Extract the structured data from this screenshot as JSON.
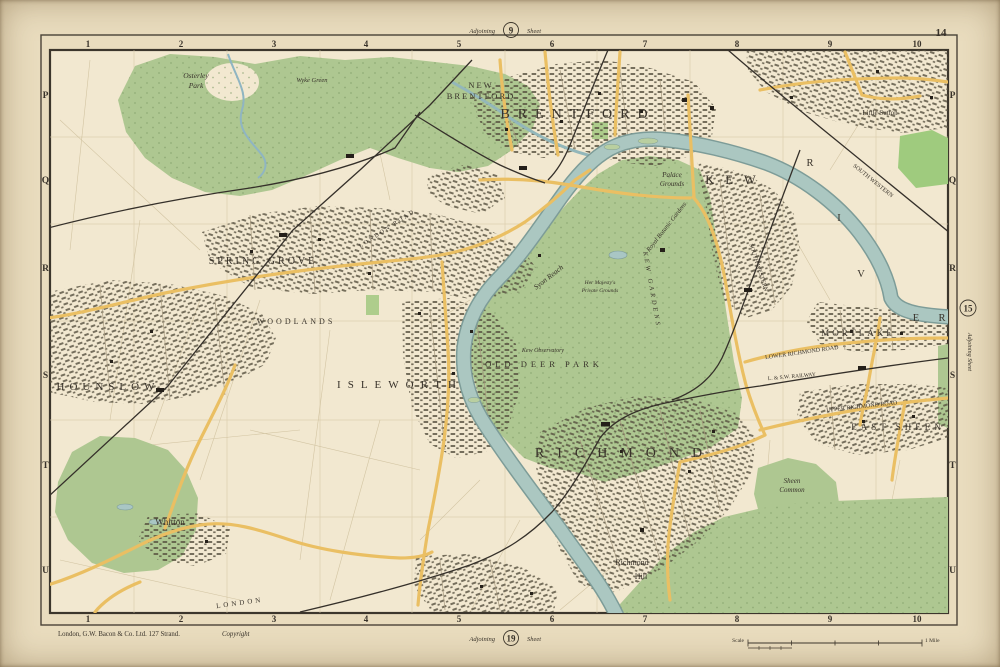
{
  "sheet": {
    "corner_number": "14",
    "adjoining_top": {
      "prefix": "Adjoining",
      "number": "9",
      "suffix": "Sheet"
    },
    "adjoining_bottom": {
      "prefix": "Adjoining",
      "number": "19",
      "suffix": "Sheet"
    },
    "adjoining_right": {
      "label": "Adjoining Sheet",
      "number": "15"
    }
  },
  "margin": {
    "columns": [
      "1",
      "2",
      "3",
      "4",
      "5",
      "6",
      "7",
      "8",
      "9",
      "10"
    ],
    "rows": [
      "P",
      "Q",
      "R",
      "S",
      "T",
      "U"
    ]
  },
  "imprint": {
    "publisher": "London, G.W. Bacon & Co. Ltd. 127 Strand.",
    "copyright": "Copyright"
  },
  "scale_bar": {
    "left_label": "Scale",
    "right_label": "1 Mile"
  },
  "colors": {
    "paper": "#e9dcbe",
    "map_background": "#f2e8d0",
    "park_green": "#aec791",
    "bright_green": "#9fcb7e",
    "river_blue": "#abc7c1",
    "river_edge": "#7d9c98",
    "road_yellow": "#eabf63",
    "railway_black": "#35302a",
    "frame_ink": "#3c362c"
  },
  "map": {
    "labels": [
      {
        "text": "NEW"
      },
      {
        "text": "BRENTFORD"
      },
      {
        "text": "BRENTFORD"
      },
      {
        "text": "KEW"
      },
      {
        "text": "R"
      },
      {
        "text": "I"
      },
      {
        "text": "V"
      },
      {
        "text": "E"
      },
      {
        "text": "R"
      },
      {
        "text": "Palace"
      },
      {
        "text": "Grounds"
      },
      {
        "text": "Royal Botanic Gardens"
      },
      {
        "text": "OLD DEER PARK"
      },
      {
        "text": "SPRING GROVE"
      },
      {
        "text": "WOODLANDS"
      },
      {
        "text": "ISLEWORTH"
      },
      {
        "text": "HOUNSLOW"
      },
      {
        "text": "Whitton"
      },
      {
        "text": "RICHMOND"
      },
      {
        "text": "Richmond"
      },
      {
        "text": "Hill"
      },
      {
        "text": "MORTLAKE"
      },
      {
        "text": "EAST SHEEN"
      },
      {
        "text": "Sheen"
      },
      {
        "text": "Common"
      },
      {
        "text": "Osterley"
      },
      {
        "text": "Park"
      },
      {
        "text": "Wyke Green"
      },
      {
        "text": "Little Sutton"
      },
      {
        "text": "Syon Reach"
      },
      {
        "text": "LONDON ROAD"
      },
      {
        "text": "UPPER RICHMOND ROAD"
      },
      {
        "text": "LOWER RICHMOND ROAD"
      },
      {
        "text": "L. & S.W. RAILWAY"
      },
      {
        "text": "SOUTH WESTERN"
      },
      {
        "text": "SOUTH WESTERN"
      },
      {
        "text": "LONDON"
      },
      {
        "text": "Kew Observatory"
      },
      {
        "text": "Her Majesty's"
      },
      {
        "text": "Private Grounds"
      },
      {
        "text": "KEW GARDENS"
      }
    ]
  }
}
